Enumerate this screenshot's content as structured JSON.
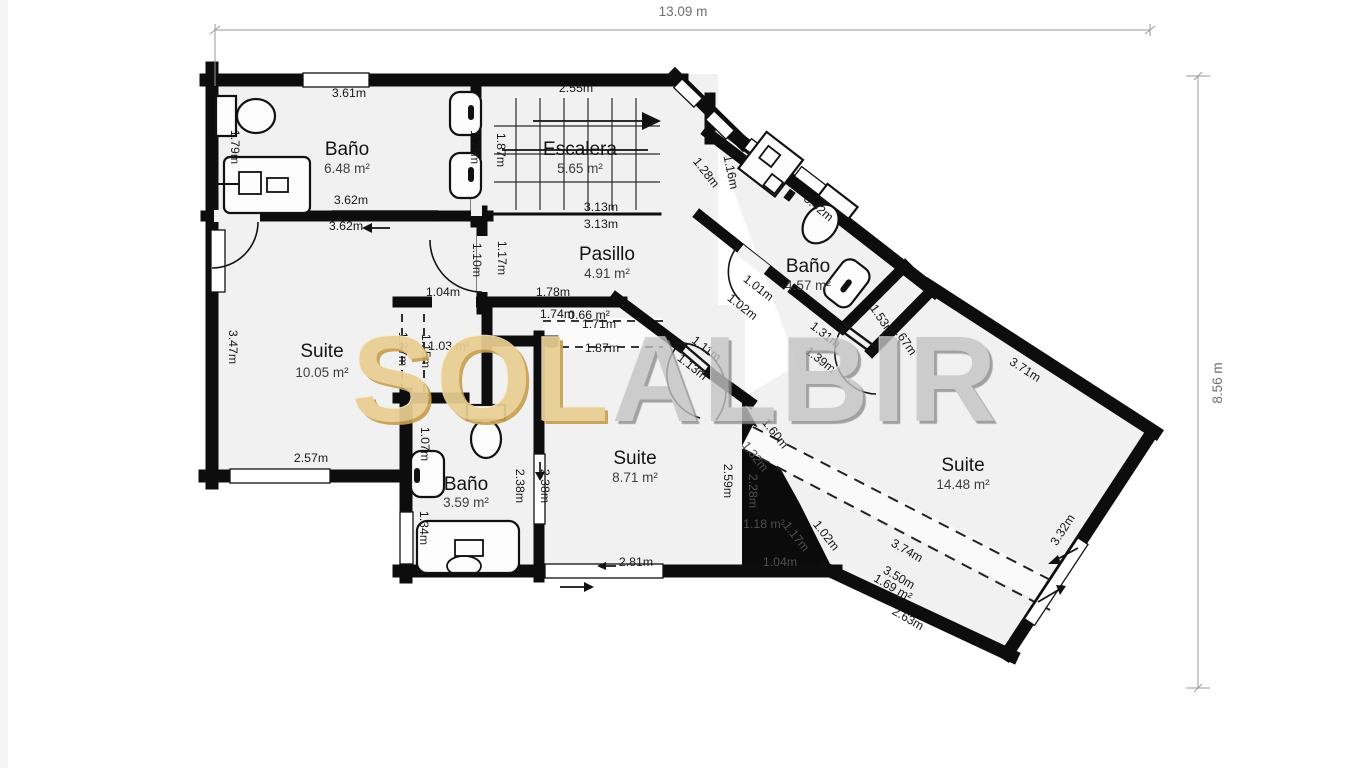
{
  "plan": {
    "dimensions": {
      "width_label": "13.09 m",
      "height_label": "8.56 m"
    },
    "watermark": {
      "left": "SOL",
      "right": "ALBIR",
      "gold_color": "#e9cd92",
      "gray_color": "#c3c3c3"
    },
    "colors": {
      "wall": "#0d0d0d",
      "floor": "#f1f1f1",
      "void_fill": "#0b0b0b",
      "dimension_text": "#6e6e6e",
      "measure_text": "#161616",
      "void_text": "#4f4f4f"
    },
    "rooms": [
      {
        "id": "bano-top-left",
        "name": "Baño",
        "area": "6.48 m²"
      },
      {
        "id": "escalera",
        "name": "Escalera",
        "area": "5.65 m²"
      },
      {
        "id": "bano-top-right",
        "name": "Baño",
        "area": "4.57 m²"
      },
      {
        "id": "pasillo",
        "name": "Pasillo",
        "area": "4.91 m²"
      },
      {
        "id": "suite-left",
        "name": "Suite",
        "area": "10.05 m²"
      },
      {
        "id": "bano-bottom",
        "name": "Baño",
        "area": "3.59 m²"
      },
      {
        "id": "suite-center",
        "name": "Suite",
        "area": "8.71 m²"
      },
      {
        "id": "suite-right",
        "name": "Suite",
        "area": "14.48 m²"
      }
    ],
    "measurements": [
      {
        "t": "3.61m"
      },
      {
        "t": "1.79m"
      },
      {
        "t": "1.79m"
      },
      {
        "t": "3.62m"
      },
      {
        "t": "3.62m"
      },
      {
        "t": "2.55m"
      },
      {
        "t": "1.87m"
      },
      {
        "t": "1.28m"
      },
      {
        "t": "3.13m"
      },
      {
        "t": "3.13m"
      },
      {
        "t": "1.17m"
      },
      {
        "t": "1.10m"
      },
      {
        "t": "1.04m"
      },
      {
        "t": "1.78m"
      },
      {
        "t": "1.74m"
      },
      {
        "t": "1.71m"
      },
      {
        "t": "1.87m"
      },
      {
        "t": "1.11m"
      },
      {
        "t": "1.13m"
      },
      {
        "t": "1.16m"
      },
      {
        "t": "3.42m"
      },
      {
        "t": "1.01m"
      },
      {
        "t": "1.02m"
      },
      {
        "t": "1.31m"
      },
      {
        "t": "1.39m"
      },
      {
        "t": "1.53m"
      },
      {
        "t": "1.67m"
      },
      {
        "t": "3.47m"
      },
      {
        "t": "1.37m"
      },
      {
        "t": "1.15m"
      },
      {
        "t": "2.57m"
      },
      {
        "t": "1.07m"
      },
      {
        "t": "2.38m"
      },
      {
        "t": "2.38m"
      },
      {
        "t": "1.34m"
      },
      {
        "t": "1.51m"
      },
      {
        "t": "2.59m"
      },
      {
        "t": "2.81m"
      },
      {
        "t": "1.60m"
      },
      {
        "t": "1.32m"
      },
      {
        "t": "2.28m"
      },
      {
        "t": "1.17m"
      },
      {
        "t": "1.04m"
      },
      {
        "t": "1.02m"
      },
      {
        "t": "3.71m"
      },
      {
        "t": "3.32m"
      },
      {
        "t": "3.74m"
      },
      {
        "t": "3.50m"
      },
      {
        "t": "2.63m"
      },
      {
        "t": "1.69 m²"
      },
      {
        "t": "1.03 m²"
      },
      {
        "t": "0.66 m²"
      },
      {
        "t": "1.18 m²"
      }
    ]
  }
}
